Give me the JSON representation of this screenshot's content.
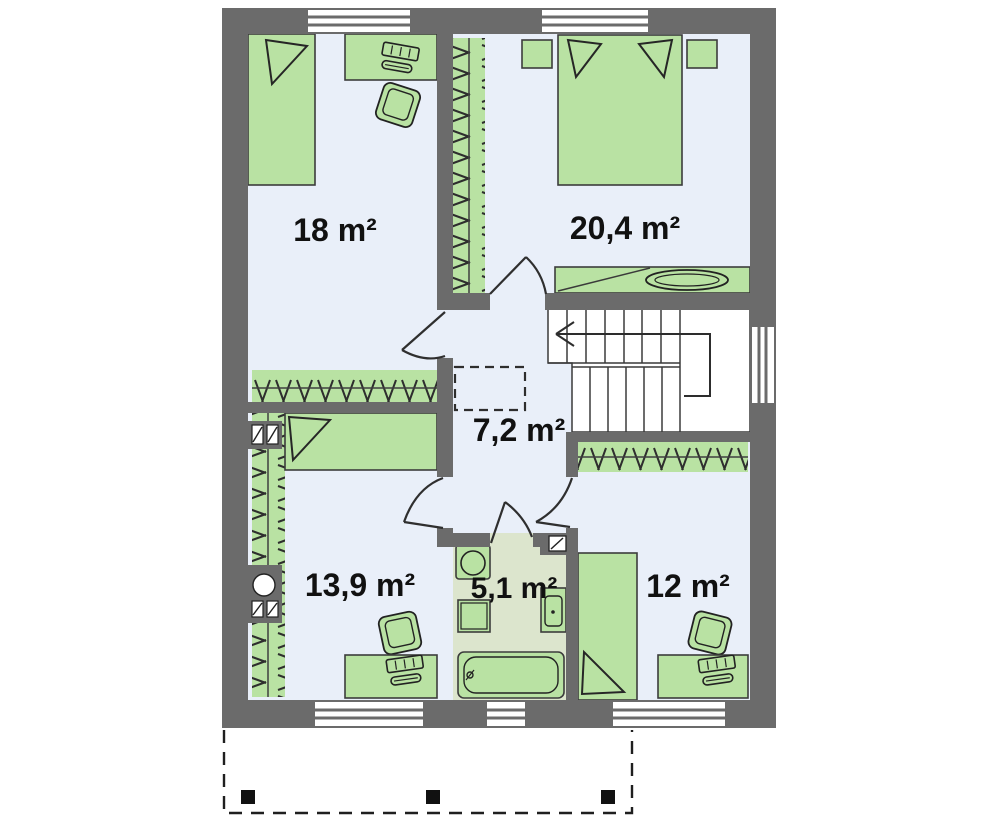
{
  "plan": {
    "type": "floor-plan-upper-storey",
    "rooms": [
      {
        "name": "bedroom-top-left",
        "area": "18 m²"
      },
      {
        "name": "bedroom-top-right",
        "area": "20,4 m²"
      },
      {
        "name": "hall",
        "area": "7,2 m²"
      },
      {
        "name": "bedroom-bottom-left",
        "area": "13,9 m²"
      },
      {
        "name": "bathroom",
        "area": "5,1 m²"
      },
      {
        "name": "bedroom-bottom-right",
        "area": "12 m²"
      }
    ],
    "colors": {
      "wall": "#6b6b6b",
      "room_floor": "#e9eff9",
      "bathroom_floor": "#dce5cd",
      "furniture_green": "#b9e2a3",
      "outline": "#2f2f2f",
      "background": "#ffffff"
    },
    "furniture": {
      "bedroom-top-left": [
        "bed",
        "desk",
        "computer",
        "office-chair",
        "wardrobe"
      ],
      "bedroom-top-right": [
        "double-bed",
        "nightstand-left",
        "nightstand-right",
        "wardrobe",
        "shelf",
        "plant"
      ],
      "hall": [
        "staircase",
        "ceiling-hatch-dashed"
      ],
      "bedroom-bottom-left": [
        "bed",
        "desk",
        "computer",
        "office-chair",
        "wardrobe",
        "chimney-vents"
      ],
      "bathroom": [
        "toilet",
        "washing-machine",
        "sink",
        "bathtub",
        "vent-shaft"
      ],
      "bedroom-bottom-right": [
        "bed",
        "desk",
        "computer",
        "office-chair",
        "wardrobe"
      ]
    },
    "exterior": {
      "terrace_posts": 3,
      "windows_top": 2,
      "windows_bottom": 3,
      "windows_right": 1
    }
  }
}
